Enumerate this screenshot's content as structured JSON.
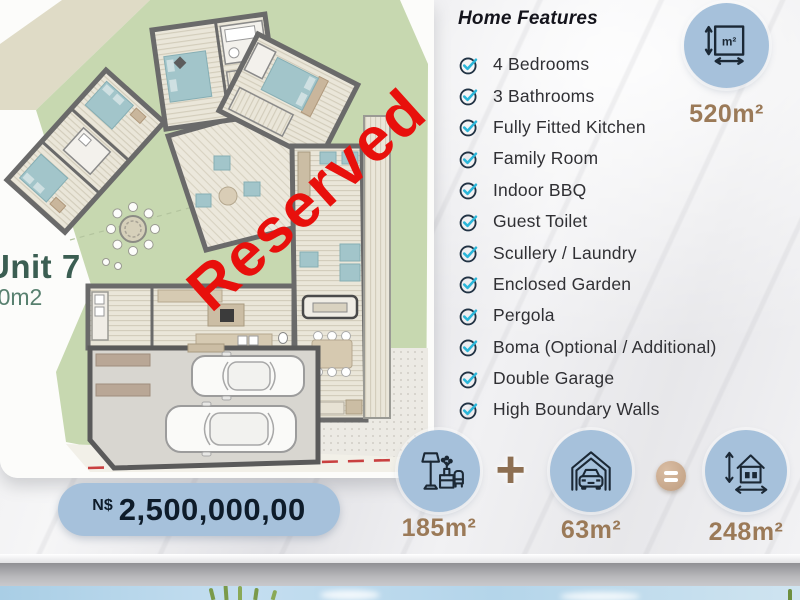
{
  "unit": {
    "name": "Unit 7",
    "stand_size_plan": "520m2"
  },
  "stamp": {
    "label": "Reserved"
  },
  "features": {
    "title": "Home Features",
    "items": [
      "4 Bedrooms",
      "3 Bathrooms",
      "Fully Fitted Kitchen",
      "Family Room",
      "Indoor BBQ",
      "Guest Toilet",
      "Scullery / Laundry",
      "Enclosed Garden",
      "Pergola",
      "Boma (Optional / Additional)",
      "Double Garage",
      "High Boundary Walls"
    ]
  },
  "stand": {
    "area": "520m²",
    "icon_label": "m²"
  },
  "area_summary": {
    "interior": {
      "label": "185m²"
    },
    "garage": {
      "label": "63m²"
    },
    "total": {
      "label": "248m²"
    },
    "plus": "+"
  },
  "price": {
    "currency": "N$",
    "amount": "2,500,000,00"
  },
  "colors": {
    "accent_blue": "#a6c1db",
    "accent_brown": "#9b7a58",
    "check_cyan": "#2bb6d9",
    "icon_navy": "#1b2835",
    "reserved_red": "#e8100c",
    "garden_green": "#c7d8b0",
    "unit_green": "#3b5e52"
  }
}
